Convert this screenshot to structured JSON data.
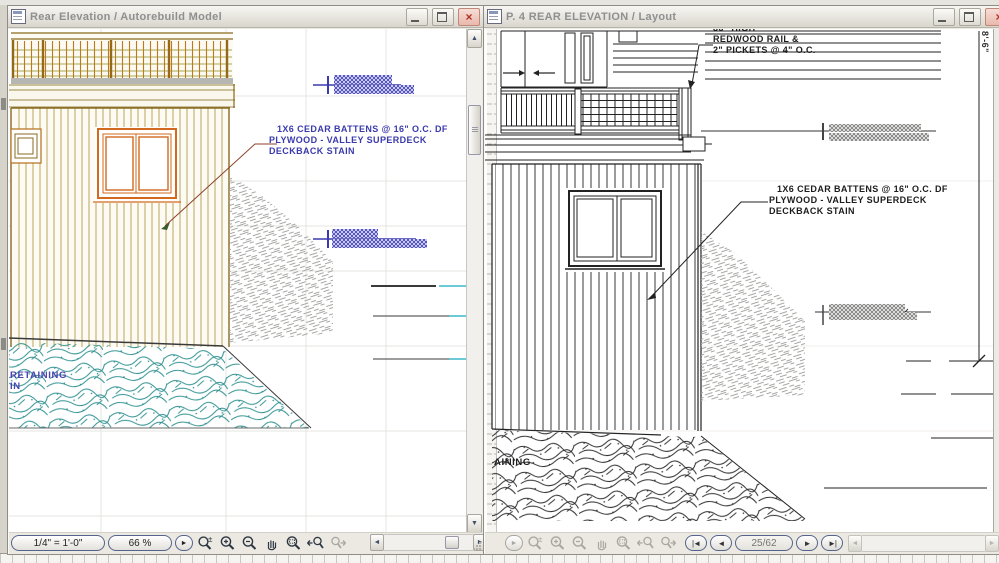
{
  "left_window": {
    "title": "Rear Elevation / Autorebuild Model",
    "drawing": {
      "battens_note": [
        "1X6 CEDAR BATTENS @ 16\" O.C. DF",
        "PLYWOOD - VALLEY SUPERDECK",
        "DECKBACK STAIN"
      ],
      "retaining_note": [
        "RETAINING",
        "IN"
      ]
    },
    "toolbar": {
      "scale": "1/4\"  =  1'-0\"",
      "zoom": "66 %"
    }
  },
  "right_window": {
    "title": "P. 4 REAR ELEVATION / Layout",
    "drawing": {
      "rail_note": [
        "36\" HIGH",
        "REDWOOD RAIL &",
        "2\" PICKETS @ 4\" O.C."
      ],
      "battens_note": [
        "1X6 CEDAR BATTENS @ 16\" O.C. DF",
        "PLYWOOD - VALLEY SUPERDECK",
        "DECKBACK STAIN"
      ],
      "retaining_note": "AINING",
      "vertical_dimension": "8'-6\""
    },
    "toolbar": {
      "page_indicator": "25/62"
    }
  },
  "glyphs": {
    "close": "×",
    "play": "►",
    "scroll_up": "▲",
    "scroll_down": "▼",
    "scroll_left": "◄",
    "scroll_right": "►",
    "nav_first": "|◄",
    "nav_prev": "◄",
    "nav_next": "►",
    "nav_last": "►|"
  },
  "colors": {
    "annotation_blue": "#3a3aad",
    "annotation_black": "#1c1c1c",
    "drawing_orange": "#cc6d1f",
    "drawing_olive": "#a8a850",
    "drawing_teal": "#2f9090",
    "selection_blue": "#5555c8",
    "leader_red": "#8b4028",
    "level_cyan": "#3ab8c8",
    "hatch_gray": "#a6a6a4"
  }
}
